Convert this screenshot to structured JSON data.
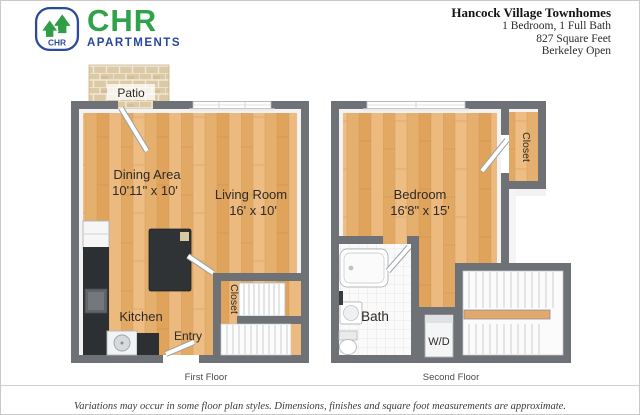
{
  "brand": {
    "chr": "CHR",
    "apartments": "APARTMENTS",
    "badge_text": "CHR",
    "green": "#2fa24a",
    "navy": "#27479e"
  },
  "header": {
    "title": "Hancock Village Townhomes",
    "line1": "1 Bedroom, 1 Full Bath",
    "line2": "827 Square Feet",
    "line3": "Berkeley Open"
  },
  "first_floor": {
    "caption": "First Floor",
    "patio": "Patio",
    "dining_name": "Dining Area",
    "dining_dims": "10'11\" x 10'",
    "living_name": "Living Room",
    "living_dims": "16' x 10'",
    "kitchen": "Kitchen",
    "entry": "Entry",
    "closet": "Closet"
  },
  "second_floor": {
    "caption": "Second Floor",
    "bedroom_name": "Bedroom",
    "bedroom_dims": "16'8\" x 15'",
    "closet": "Closet",
    "bath": "Bath",
    "wd": "W/D"
  },
  "footer": {
    "disclaimer": "Variations may occur in some floor plan styles. Dimensions, finishes and square foot measurements are approximate."
  },
  "colors": {
    "wall_gray": "#6e7277",
    "wood": "#e8b577",
    "brick": "#dcc9a6",
    "counter_black": "#2d3033",
    "tile": "#fafafa"
  }
}
